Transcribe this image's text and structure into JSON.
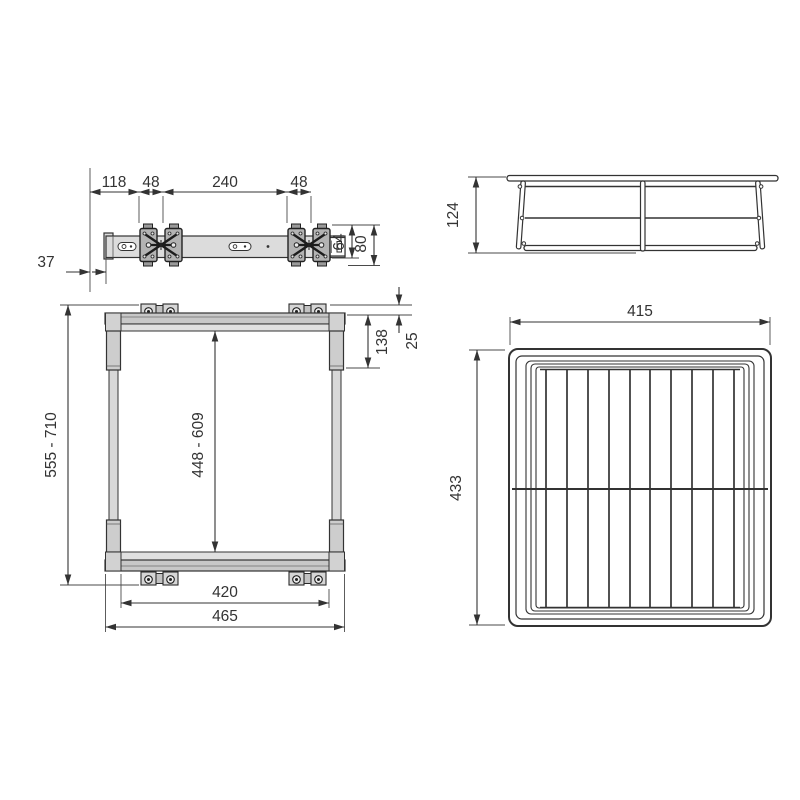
{
  "views": {
    "slide_rail_top": {
      "title": "slide rail top view",
      "dims": {
        "rear_offset": "118",
        "bracket_width_a": "48",
        "bracket_spacing": "240",
        "bracket_width_b": "48",
        "side_offset": "37",
        "bracket_height": "64",
        "total_height": "80"
      }
    },
    "basket_side": {
      "title": "basket side view",
      "dims": {
        "basket_height": "124"
      }
    },
    "frame_front": {
      "title": "frame front view",
      "dims": {
        "frame_height_range": "555 - 710",
        "inner_height_range": "448 - 609",
        "upper_section": "138",
        "top_offset": "25",
        "inner_width": "420",
        "outer_width": "465"
      }
    },
    "basket_top": {
      "title": "basket top view",
      "dims": {
        "basket_width": "415",
        "basket_depth": "433"
      }
    }
  },
  "colors": {
    "line": "#333333",
    "rail_fill": "#dcdcdc",
    "bracket_fill": "#b3b3b3",
    "bar_fill": "#c8c8c8",
    "background": "#ffffff"
  }
}
